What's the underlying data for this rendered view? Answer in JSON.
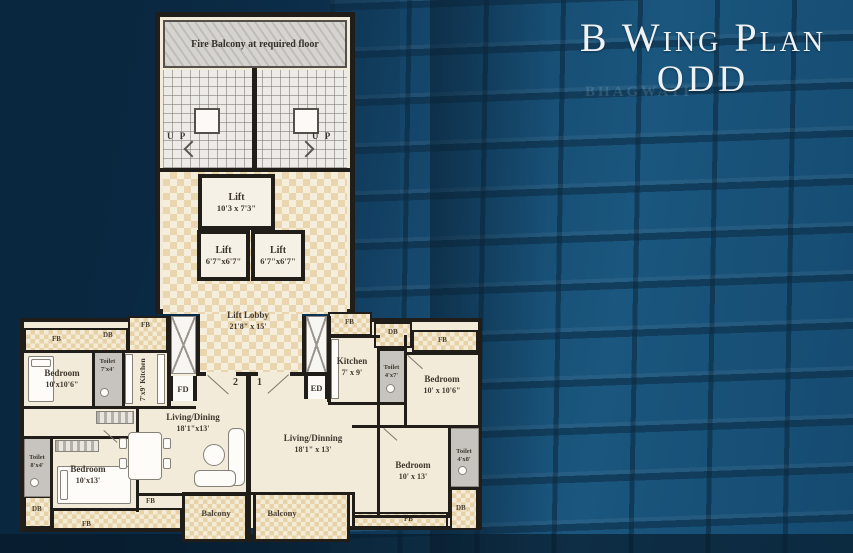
{
  "title": {
    "line1": "B Wing Plan",
    "line2": "ODD"
  },
  "watermark": "BHAGWATI",
  "tower": {
    "fire_balcony": "Fire Balcony at required floor",
    "up_left": "U P",
    "up_right": "U P",
    "lift_main": {
      "name": "Lift",
      "size": "10'3 x 7'3\""
    },
    "lift_small_left": {
      "name": "Lift",
      "size": "6'7\"x6'7\""
    },
    "lift_small_right": {
      "name": "Lift",
      "size": "6'7\"x6'7\""
    },
    "lobby": {
      "name": "Lift Lobby",
      "size": "21'8\" x 15'"
    }
  },
  "markers": {
    "fb": "FB",
    "db": "DB",
    "fd": "FD",
    "ed": "ED",
    "balcony": "Balcony",
    "flat1_no": "1",
    "flat2_no": "2"
  },
  "flat2": {
    "bedroom1": {
      "name": "Bedroom",
      "size": "10'x10'6\""
    },
    "toilet1": {
      "name": "Toilet",
      "size": "7'x4'"
    },
    "kitchen": {
      "label": "7'x9' Kitchen"
    },
    "living": {
      "name": "Living/Dining",
      "size": "18'1\"x13'"
    },
    "bedroom2": {
      "name": "Bedroom",
      "size": "10'x13'"
    },
    "toilet2": {
      "name": "Toilet",
      "size": "8'x4'"
    }
  },
  "flat1": {
    "kitchen": {
      "name": "Kitchen",
      "size": "7' x 9'"
    },
    "toilet1": {
      "name": "Toilet",
      "size": "4'x7'"
    },
    "bedroom1": {
      "name": "Bedroom",
      "size": "10' x 10'6\""
    },
    "living": {
      "name": "Living/Dinning",
      "size": "18'1\" x 13'"
    },
    "bedroom2": {
      "name": "Bedroom",
      "size": "10' x 13'"
    },
    "toilet2": {
      "name": "Toilet",
      "size": "4'x8'"
    }
  },
  "colors": {
    "background": "#0e3a5c",
    "plan_cream": "#f2ebda",
    "checker_dark": "#e9d6af",
    "wall": "#211e19",
    "title_text": "#eef2f4"
  }
}
